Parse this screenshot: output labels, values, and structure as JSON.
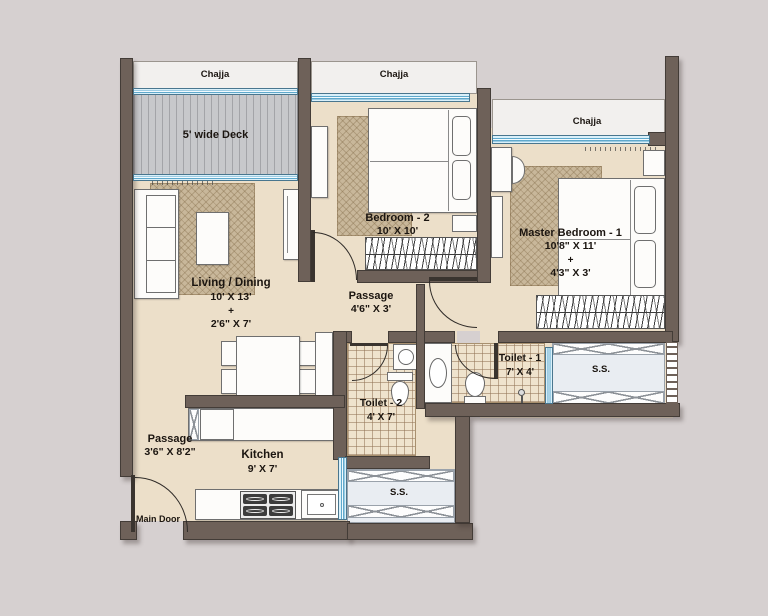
{
  "plan": {
    "chajjas": {
      "left": "Chajja",
      "middle": "Chajja",
      "right": "Chajja"
    },
    "deck": {
      "label": "5' wide Deck"
    },
    "rooms": {
      "living_dining": {
        "name": "Living / Dining",
        "dim1": "10' X 13'",
        "plus": "+",
        "dim2": "2'6\" X 7'"
      },
      "bedroom2": {
        "name": "Bedroom - 2",
        "dim": "10' X 10'"
      },
      "master_bedroom": {
        "name": "Master Bedroom - 1",
        "dim1": "10'8\" X 11'",
        "plus": "+",
        "dim2": "4'3\" X 3'"
      },
      "passage_middle": {
        "name": "Passage",
        "dim": "4'6\" X 3'"
      },
      "passage_entry": {
        "name": "Passage",
        "dim": "3'6\" X 8'2\""
      },
      "toilet1": {
        "name": "Toilet - 1",
        "dim": "7' X 4'"
      },
      "toilet2": {
        "name": "Toilet - 2",
        "dim": "4' X 7'"
      },
      "kitchen": {
        "name": "Kitchen",
        "dim": "9' X 7'"
      }
    },
    "entry": {
      "main_door": "Main Door"
    },
    "service": {
      "right": "S.S.",
      "bottom": "S.S."
    }
  },
  "colors": {
    "bg": "#d6d0d0",
    "wall": "#6e6159",
    "floor": "#ecdfc9",
    "chajja": "#f2f0ee",
    "deck": "#c7c8cb",
    "window": "#8ccfe8",
    "rug": "#c8b79a",
    "tile": "#efe3cd",
    "ss": "#e9edf2",
    "text": "#1b1510"
  }
}
